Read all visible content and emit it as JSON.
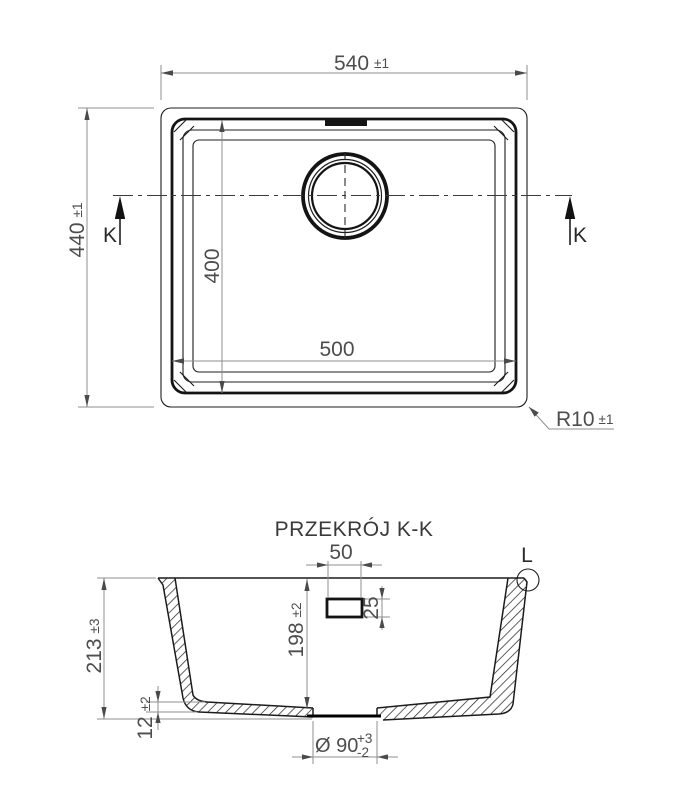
{
  "top_view": {
    "width": {
      "value": "540",
      "tolerance": "±1"
    },
    "height": {
      "value": "440",
      "tolerance": "±1"
    },
    "bowl_width": {
      "value": "500"
    },
    "bowl_height": {
      "value": "400"
    },
    "corner_radius": {
      "value": "R10",
      "tolerance": "±1"
    },
    "section_marker": "K"
  },
  "section_view": {
    "title": "PRZEKRÓJ K-K",
    "overflow_width": {
      "value": "50"
    },
    "overflow_height": {
      "value": "25"
    },
    "bowl_depth": {
      "value": "198",
      "tolerance": "±2"
    },
    "total_height": {
      "value": "213",
      "tolerance": "±3"
    },
    "base_thickness": {
      "value": "12",
      "tolerance": "±2"
    },
    "drain_diameter": {
      "value": "Ø 90",
      "tolerance_plus": "+3",
      "tolerance_minus": "-2"
    },
    "detail_marker": "L"
  },
  "colors": {
    "object_line": "#1c1c1c",
    "dimension_line": "#8f8f8f",
    "dimension_text": "#4d4d4d",
    "background": "#ffffff"
  }
}
